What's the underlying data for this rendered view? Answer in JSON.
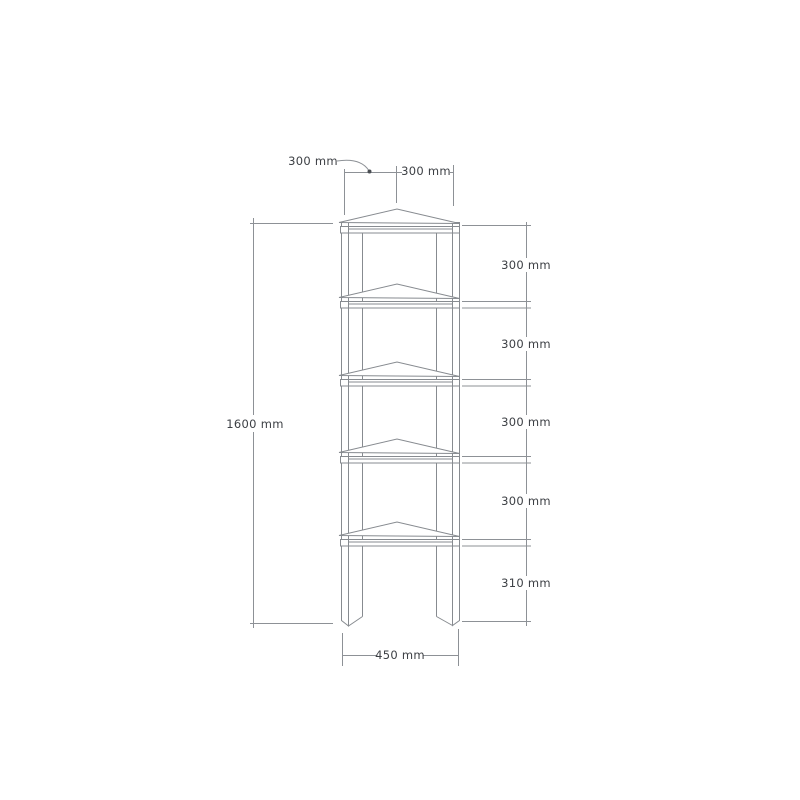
{
  "page": {
    "background": "#ffffff"
  },
  "diagram": {
    "kind": "furniture-dimension-drawing",
    "subject": "corner shelf unit front elevation",
    "shelf_count": 5,
    "colors": {
      "line": "#878b90",
      "label_text": "#3d4045",
      "background": "#ffffff"
    },
    "dimensions": {
      "top_left_depth": "300 mm",
      "top_right_width": "300 mm",
      "total_height": "1600 mm",
      "shelf_spacings": [
        "300 mm",
        "300 mm",
        "300 mm",
        "300 mm",
        "310 mm"
      ],
      "base_width": "450 mm"
    }
  }
}
